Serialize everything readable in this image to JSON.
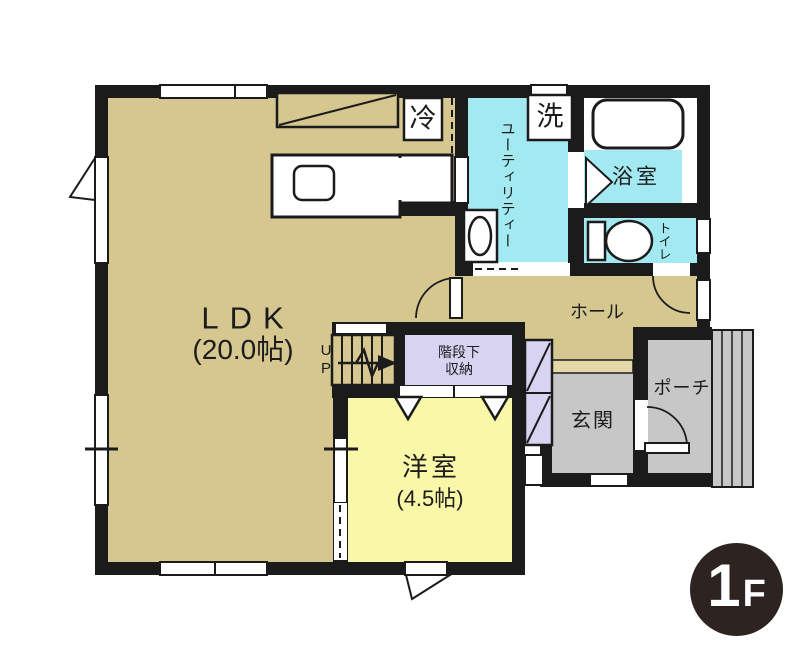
{
  "floor_plan": {
    "floor_badge": {
      "level": "1",
      "suffix": "F"
    },
    "rooms": {
      "ldk": {
        "name": "LDK",
        "size": "(20.0帖)"
      },
      "utility": {
        "name": "ユーティリティー"
      },
      "bathroom": {
        "name": "浴室"
      },
      "toilet": {
        "name": "トイレ"
      },
      "hall": {
        "name": "ホール"
      },
      "under_stairs_storage": {
        "line1": "階段下",
        "line2": "収納"
      },
      "western_room": {
        "name": "洋室",
        "size": "(4.5帖)"
      },
      "entrance": {
        "name": "玄関"
      },
      "porch": {
        "name": "ポーチ"
      }
    },
    "labels": {
      "stairs_up": "UP",
      "refrigerator": "冷",
      "washer": "洗"
    },
    "colors": {
      "floor_tan": "#d5c78f",
      "step_tan": "#e4d7a8",
      "wet_area_cyan": "#a2e9f1",
      "room_yellow": "#f9f8a8",
      "storage_lavender": "#d7d3f0",
      "entry_gray": "#c7c7c7",
      "wall_black": "#1b1b1b",
      "badge_brown": "#2d2320"
    }
  }
}
